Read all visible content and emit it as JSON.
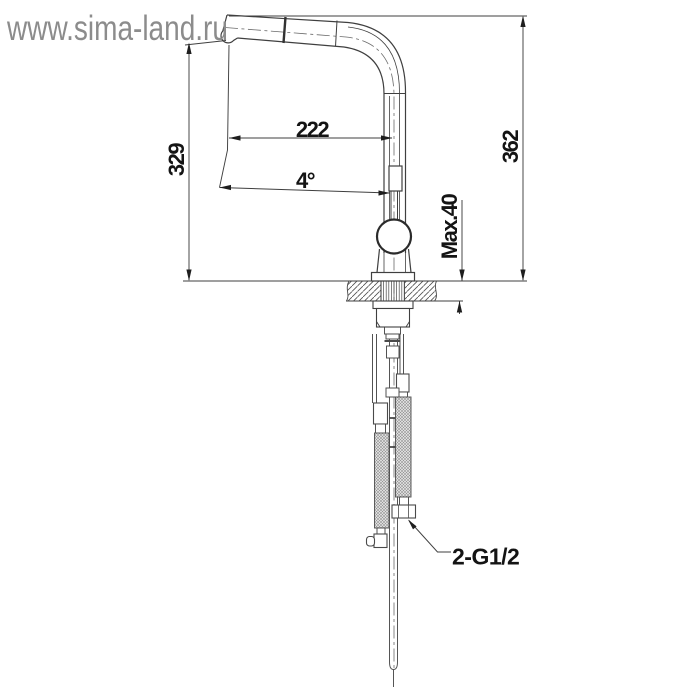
{
  "watermark": {
    "text": "www.sima-land.ru",
    "color": "#8c8c8c"
  },
  "dimensions": {
    "spout_reach": "222",
    "spout_angle": "4°",
    "spout_height": "329",
    "total_height": "362",
    "max_counter_thickness": "Max.40",
    "connection_thread": "2-G1/2"
  },
  "drawing": {
    "subject": "pull-out kitchen faucet side-view installation drawing",
    "line_color": "#3f3f3f",
    "text_color": "#141414",
    "background": "#ffffff"
  }
}
